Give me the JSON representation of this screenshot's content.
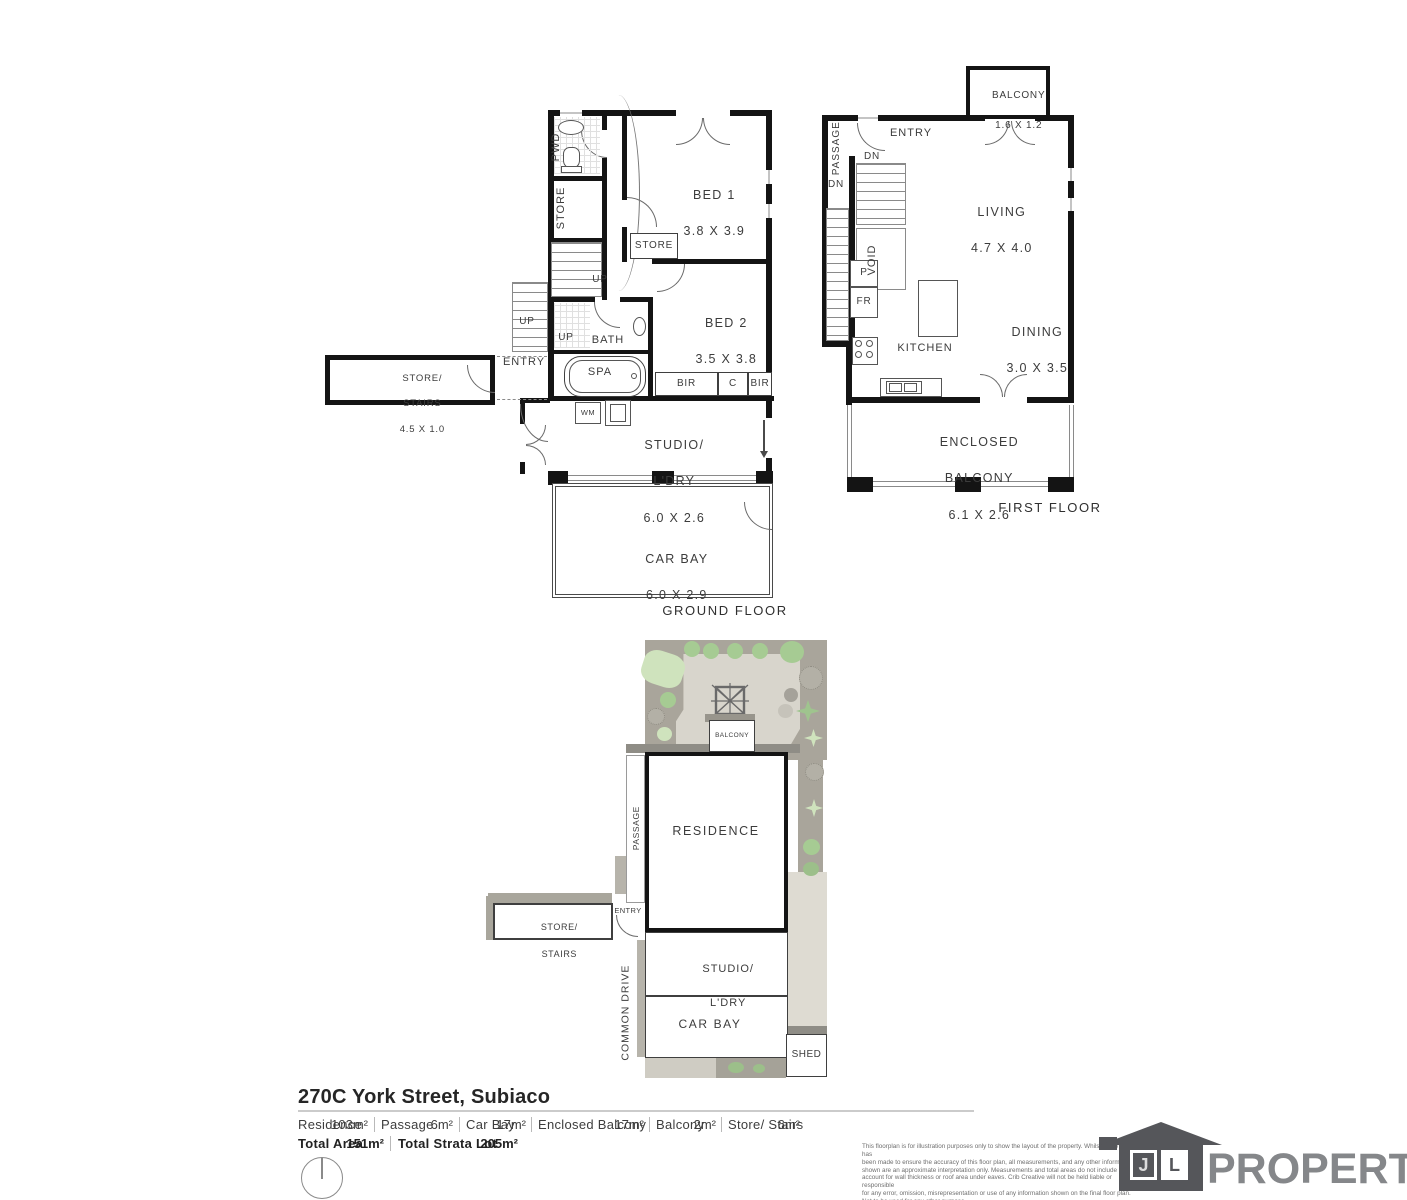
{
  "title": "270C York Street, Subiaco",
  "ground_floor": {
    "caption": "GROUND FLOOR",
    "pwd": "PWD",
    "store_column": "STORE",
    "up_inner": "UP",
    "up_outer": "UP",
    "up_bath": "UP",
    "bath": "BATH",
    "spa": "SPA",
    "entry": "ENTRY",
    "store_stairs_line1": "STORE/",
    "store_stairs_line2": "STAIRS",
    "store_stairs_size": "4.5 X 1.0",
    "bed1_name": "BED 1",
    "bed1_size": "3.8 X 3.9",
    "bed1_store": "STORE",
    "bed2_name": "BED 2",
    "bed2_size": "3.5 X 3.8",
    "bir_left": "BIR",
    "cupboard": "C",
    "bir_right": "BIR",
    "wm": "WM",
    "studio_line1": "STUDIO/",
    "studio_line2": "L'DRY",
    "studio_size": "6.0 X 2.6",
    "carbay_name": "CAR BAY",
    "carbay_size": "6.0 X 2.9"
  },
  "first_floor": {
    "caption": "FIRST FLOOR",
    "balcony_name": "BALCONY",
    "balcony_size": "1.6 X 1.2",
    "entry": "ENTRY",
    "passage": "PASSAGE",
    "dn_inner": "DN",
    "dn_passage": "DN",
    "void": "VOID",
    "pantry": "P",
    "fridge": "FR",
    "kitchen": "KITCHEN",
    "living_name": "LIVING",
    "living_size": "4.7 X 4.0",
    "dining_name": "DINING",
    "dining_size": "3.0 X 3.5",
    "enclosed_line1": "ENCLOSED",
    "enclosed_line2": "BALCONY",
    "enclosed_size": "6.1 X 2.6"
  },
  "site_plan": {
    "residence": "RESIDENCE",
    "balcony": "BALCONY",
    "passage": "PASSAGE",
    "entry": "ENTRY",
    "store_stairs_line1": "STORE/",
    "store_stairs_line2": "STAIRS",
    "common_drive": "COMMON DRIVE",
    "studio_line1": "STUDIO/",
    "studio_line2": "L'DRY",
    "carbay": "CAR BAY",
    "shed": "SHED"
  },
  "areas": {
    "items": [
      {
        "label": "Residence",
        "value": "103m²"
      },
      {
        "label": "Passage",
        "value": "6m²"
      },
      {
        "label": "Car Bay",
        "value": "17m²"
      },
      {
        "label": "Enclosed Balcony",
        "value": "17m²"
      },
      {
        "label": "Balcony",
        "value": "2m²"
      },
      {
        "label": "Store/ Stairs",
        "value": "6m²"
      }
    ],
    "totals": [
      {
        "label": "Total Area",
        "value": "151m²"
      },
      {
        "label": "Total Strata Lot",
        "value": "205m²"
      }
    ]
  },
  "disclaimer": "This floorplan is for illustration purposes only to show the layout of the property. Whilst every effort has\nbeen made to ensure the accuracy of this floor plan, all measurements, and any other information\nshown are an approximate interpretation only. Measurements and total areas do not include or\naccount for wall thickness or roof area under eaves. Crib Creative will not be held liable or responsible\nfor any error, omission, misrepresentation or use of any information shown on the final floor plan.\nNot to be used for any other purpose.\nwww.cribcreative.com.au",
  "logo": {
    "letter_j": "J",
    "letter_l": "L",
    "wordmark": "PROPERTY"
  },
  "colors": {
    "wall": "#141414",
    "garden": "#a9a59b",
    "courtyard": "#d8d5cc",
    "tree_light": "#cfe3bd",
    "tree_green": "#a6cb93",
    "tree_gray": "#b3b0a6",
    "path": "#dedbd2",
    "paving_dark": "#8f8d86",
    "logo_house": "#55565a",
    "logo_text": "#85878a"
  }
}
